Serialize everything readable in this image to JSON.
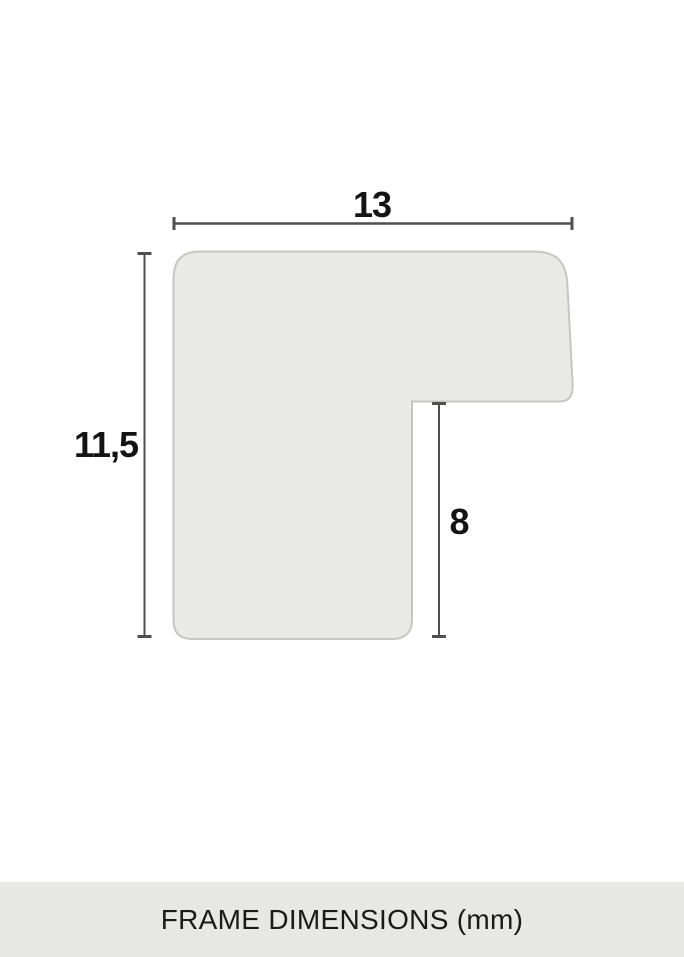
{
  "diagram": {
    "title": "frame profile cross-section",
    "colors": {
      "background": "#ffffff",
      "shape_fill": "#e9e9e5",
      "shape_stroke": "#c5c5c1",
      "dimension_line": "#4f4f4f",
      "label_text": "#141414"
    },
    "measurements": {
      "width": {
        "value": "13",
        "orientation": "horizontal"
      },
      "height": {
        "value": "11,5",
        "orientation": "vertical"
      },
      "rabbet_depth": {
        "value": "8",
        "orientation": "vertical"
      }
    }
  },
  "footer": {
    "label": "FRAME DIMENSIONS (mm)",
    "background": "#e7e7e3",
    "text_color": "#1a1a1a"
  }
}
